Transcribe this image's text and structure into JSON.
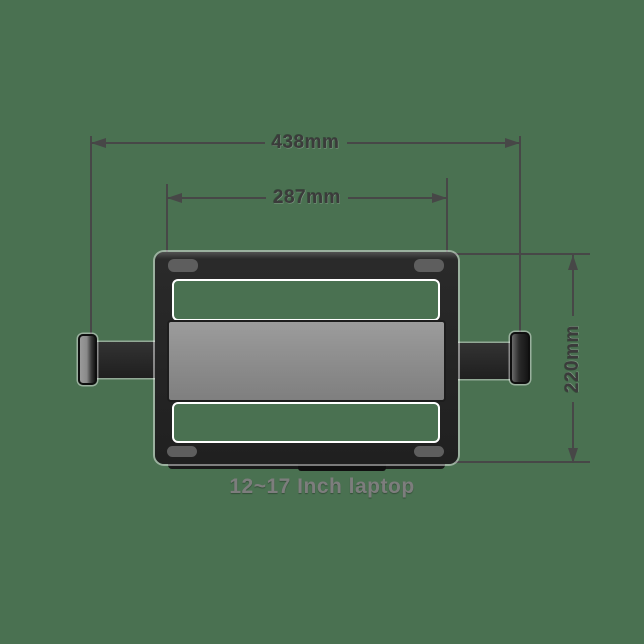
{
  "diagram": {
    "caption": "12~17 Inch laptop",
    "dimensions": {
      "outer_width": "438mm",
      "inner_width": "287mm",
      "height": "220mm"
    },
    "colors": {
      "background": "#4a7151",
      "frame": "#242424",
      "platform": "#8f8f8f",
      "slot": "#5e5e5e",
      "cutout_border": "#ffffff",
      "dim_line": "#474747",
      "dim_text": "#3b3b3b",
      "caption_text": "#7d7d7d"
    }
  }
}
